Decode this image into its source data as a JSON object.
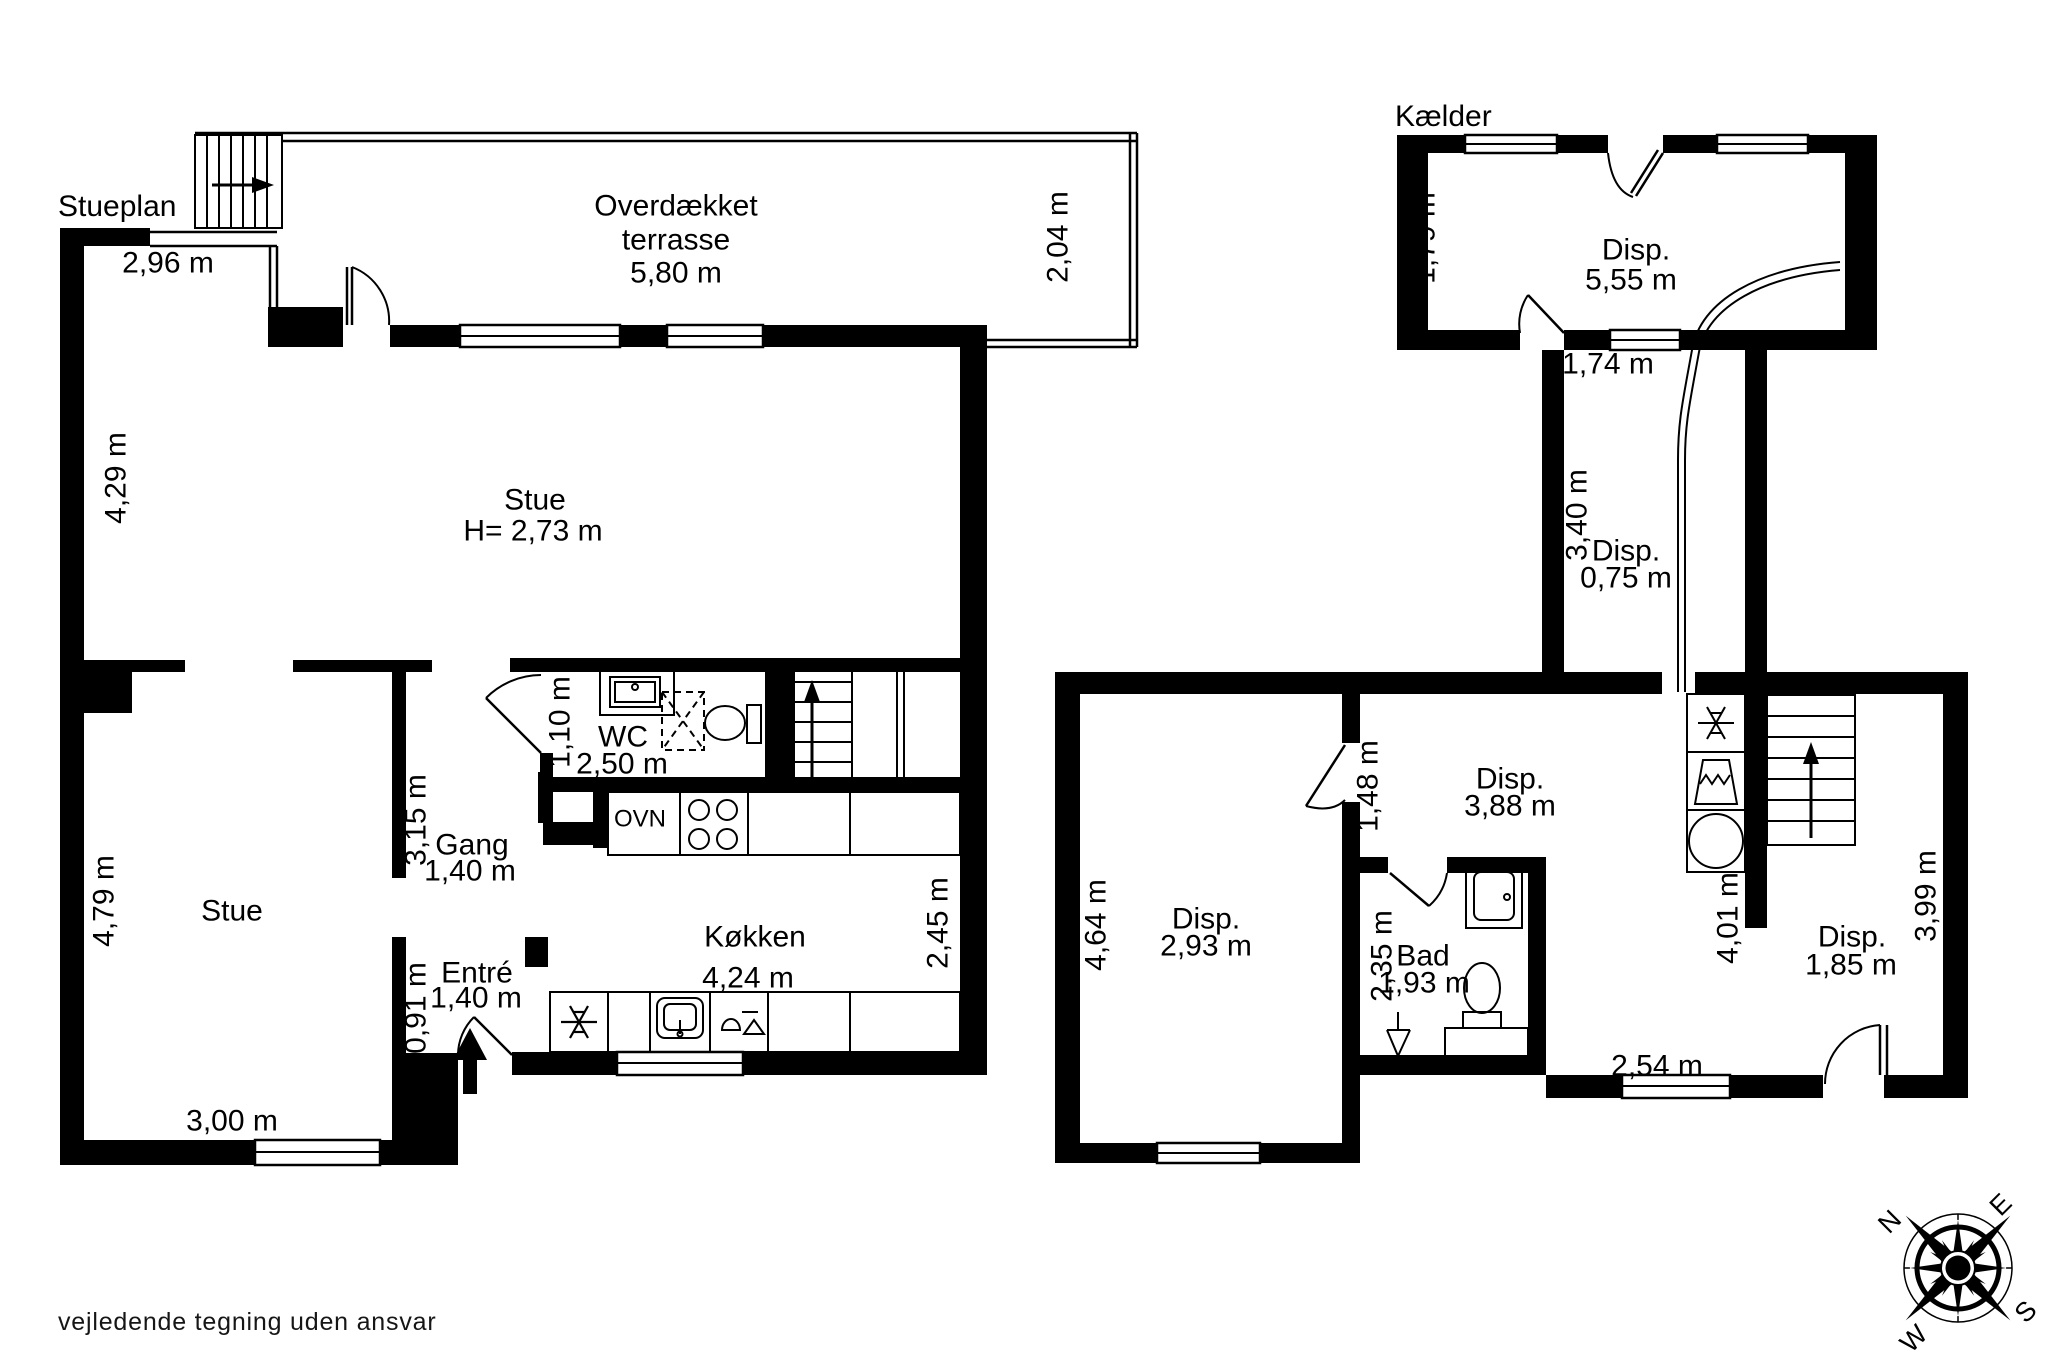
{
  "gf": {
    "title": "Stueplan",
    "top_wall_dim": "2,96 m",
    "terrace_name": "Overdækket terrasse",
    "terrace_w": "5,80 m",
    "terrace_d": "2,04 m",
    "stue_left_dim": "4,29 m",
    "stue_name": "Stue",
    "stue_height": "H= 2,73 m",
    "wc_door_dim": "1,10 m",
    "wc_name": "WC",
    "wc_w": "2,50 m",
    "gang_d": "3,15 m",
    "gang_name": "Gang",
    "gang_w": "1,40 m",
    "ovn": "OVN",
    "kokken_name": "Køkken",
    "kokken_w": "4,24 m",
    "kokken_d": "2,45 m",
    "entre_name": "Entré",
    "entre_w": "1,40 m",
    "entre_d": "0,91 m",
    "stue2_name": "Stue",
    "stue2_left_dim": "4,79 m",
    "stue2_w": "3,00 m"
  },
  "bs": {
    "title": "Kælder",
    "disp1_name": "Disp.",
    "disp1_w": "5,55 m",
    "disp1_d": "1,79 m",
    "disp1_door": "1,74 m",
    "corr_d": "3,40 m",
    "corr_name": "Disp.",
    "corr_w": "0,75 m",
    "disp2_name": "Disp.",
    "disp2_w": "3,88 m",
    "disp2_door": "1,48 m",
    "disp3_name": "Disp.",
    "disp3_w": "2,93 m",
    "disp3_d": "4,64 m",
    "bad_name": "Bad",
    "bad_w": "1,93 m",
    "bad_d": "2,35 m",
    "disp4_name": "Disp.",
    "disp4_w": "1,85 m",
    "disp4_d": "3,99 m",
    "disp4_l": "4,01 m",
    "passage_w": "2,54 m"
  },
  "compass": {
    "n": "N",
    "e": "E",
    "s": "S",
    "w": "W"
  },
  "footer": {
    "disclaimer": "vejledende tegning uden ansvar"
  }
}
